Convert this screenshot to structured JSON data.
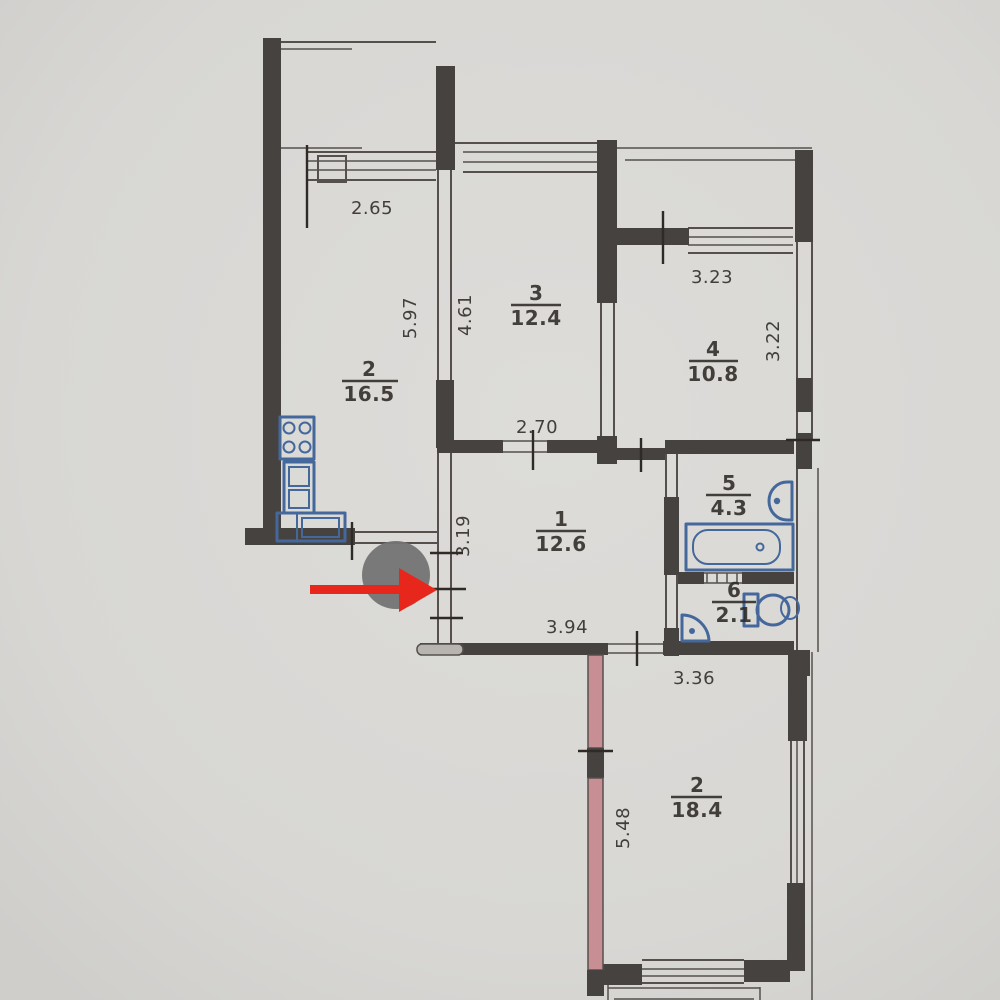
{
  "meta": {
    "title": "Scanned apartment floor plan with location marker"
  },
  "colors": {
    "paper": "#d8d7d4",
    "wall": "#46423f",
    "line": "#55504c",
    "ink": "#2e2a26",
    "blue": "#44689b",
    "pink": "#c78f93",
    "red": "#e8271c",
    "gray": "#747474"
  },
  "rooms": [
    {
      "id": "kitchen-living",
      "number": "2",
      "area": "16.5"
    },
    {
      "id": "room-3",
      "number": "3",
      "area": "12.4"
    },
    {
      "id": "room-4",
      "number": "4",
      "area": "10.8"
    },
    {
      "id": "bathroom",
      "number": "5",
      "area": "4.3"
    },
    {
      "id": "hallway",
      "number": "1",
      "area": "12.6"
    },
    {
      "id": "wc",
      "number": "6",
      "area": "2.1"
    },
    {
      "id": "bedroom",
      "number": "2",
      "area": "18.4"
    }
  ],
  "dimensions": [
    {
      "id": "kitchen-window-width",
      "value": "2.65",
      "orientation": "horizontal"
    },
    {
      "id": "kitchen-depth",
      "value": "5.97",
      "orientation": "vertical"
    },
    {
      "id": "room3-depth",
      "value": "4.61",
      "orientation": "vertical"
    },
    {
      "id": "room3-width",
      "value": "2.70",
      "orientation": "horizontal"
    },
    {
      "id": "room4-width",
      "value": "3.23",
      "orientation": "horizontal"
    },
    {
      "id": "room4-depth",
      "value": "3.22",
      "orientation": "vertical"
    },
    {
      "id": "hall-left-depth",
      "value": "3.19",
      "orientation": "vertical"
    },
    {
      "id": "hall-width",
      "value": "3.94",
      "orientation": "horizontal"
    },
    {
      "id": "bedroom-width",
      "value": "3.36",
      "orientation": "horizontal"
    },
    {
      "id": "bedroom-depth",
      "value": "5.48",
      "orientation": "vertical"
    }
  ],
  "annotation": {
    "shape": "gray-circle-with-red-arrow",
    "arrow_direction": "right"
  }
}
